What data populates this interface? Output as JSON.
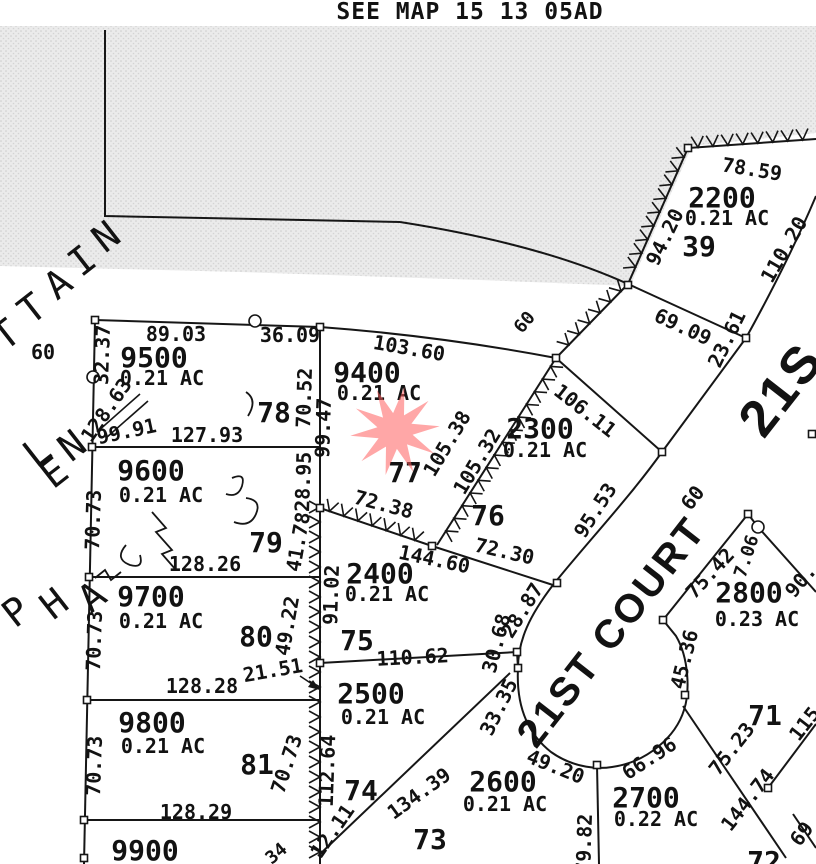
{
  "title": "SEE MAP 15 13 05AD",
  "star": {
    "color": "#ff5f5f",
    "meaning": "marker-on-lot-9400"
  },
  "streets": {
    "court_label": "21ST COURT",
    "main_street_partial": "21S",
    "right_of_way_widths": [
      "60",
      "60",
      "60"
    ],
    "diagonal_letters": [
      "T",
      "T",
      "A",
      "I",
      "N",
      "L",
      "E",
      "N",
      "P",
      "H",
      "A"
    ]
  },
  "lots": [
    {
      "parcel": "2200",
      "acreage": "0.21 AC",
      "lot": "39"
    },
    {
      "parcel": "9500",
      "acreage": "0.21 AC",
      "lot": "78"
    },
    {
      "parcel": "9400",
      "acreage": "0.21 AC",
      "lot": "77",
      "marked_with_star": true
    },
    {
      "parcel": "2300",
      "acreage": "0.21 AC",
      "lot": "76"
    },
    {
      "parcel": "2400",
      "acreage": "0.21 AC",
      "lot": "75"
    },
    {
      "parcel": "9600",
      "acreage": "0.21 AC",
      "lot": "79"
    },
    {
      "parcel": "9700",
      "acreage": "0.21 AC",
      "lot": "80"
    },
    {
      "parcel": "9800",
      "acreage": "0.21 AC",
      "lot": "81"
    },
    {
      "parcel": "2500",
      "acreage": "0.21 AC",
      "lot": "74"
    },
    {
      "parcel": "2600",
      "acreage": "0.21 AC",
      "lot": "73"
    },
    {
      "parcel": "2700",
      "acreage": "0.22 AC"
    },
    {
      "parcel": "2800",
      "acreage": "0.23 AC",
      "lot": "71"
    },
    {
      "parcel": "9900"
    },
    {
      "lot": "72",
      "partial": true
    }
  ],
  "labels": [
    {
      "t": "SEE MAP 15 13 05AD",
      "x": 470,
      "y": 19,
      "r": 0,
      "s": 23,
      "c": "title"
    },
    {
      "t": "2200",
      "x": 722,
      "y": 207,
      "r": 0,
      "s": 28,
      "c": "num"
    },
    {
      "t": "0.21 AC",
      "x": 727,
      "y": 225,
      "r": 0,
      "s": 20,
      "c": "ac"
    },
    {
      "t": "39",
      "x": 699,
      "y": 256,
      "r": 0,
      "s": 28,
      "c": "num"
    },
    {
      "t": "78.59",
      "x": 751,
      "y": 176,
      "r": 9,
      "s": 20,
      "c": "dim"
    },
    {
      "t": "94.20",
      "x": 671,
      "y": 240,
      "r": -64,
      "s": 20,
      "c": "dim"
    },
    {
      "t": "110.20",
      "x": 790,
      "y": 253,
      "r": -60,
      "s": 20,
      "c": "dim"
    },
    {
      "t": "69.09",
      "x": 680,
      "y": 333,
      "r": 25,
      "s": 20,
      "c": "dim"
    },
    {
      "t": "23.61",
      "x": 733,
      "y": 342,
      "r": -64,
      "s": 20,
      "c": "dim"
    },
    {
      "t": "9500",
      "x": 154,
      "y": 367,
      "r": 0,
      "s": 28,
      "c": "num"
    },
    {
      "t": "0.21 AC",
      "x": 162,
      "y": 385,
      "r": 0,
      "s": 20,
      "c": "ac"
    },
    {
      "t": "78",
      "x": 274,
      "y": 422,
      "r": 0,
      "s": 28,
      "c": "num"
    },
    {
      "t": "89.03",
      "x": 176,
      "y": 341,
      "r": 0,
      "s": 20,
      "c": "dim"
    },
    {
      "t": "36.09",
      "x": 290,
      "y": 342,
      "r": 0,
      "s": 20,
      "c": "dim"
    },
    {
      "t": "32.37",
      "x": 109,
      "y": 355,
      "r": -88,
      "s": 20,
      "c": "dim"
    },
    {
      "t": "70.52",
      "x": 311,
      "y": 398,
      "r": -88,
      "s": 20,
      "c": "dim"
    },
    {
      "t": "127.93",
      "x": 207,
      "y": 442,
      "r": 0,
      "s": 20,
      "c": "dim"
    },
    {
      "t": "128.63",
      "x": 112,
      "y": 414,
      "r": -55,
      "s": 20,
      "c": "dim"
    },
    {
      "t": "99.91",
      "x": 128,
      "y": 438,
      "r": -12,
      "s": 20,
      "c": "dim"
    },
    {
      "t": "60",
      "x": 43,
      "y": 359,
      "r": 0,
      "s": 20,
      "c": "dim"
    },
    {
      "t": "9400",
      "x": 367,
      "y": 382,
      "r": 0,
      "s": 28,
      "c": "num"
    },
    {
      "t": "0.21 AC",
      "x": 379,
      "y": 400,
      "r": 0,
      "s": 20,
      "c": "ac"
    },
    {
      "t": "77",
      "x": 405,
      "y": 482,
      "r": 0,
      "s": 28,
      "c": "num"
    },
    {
      "t": "103.60",
      "x": 408,
      "y": 355,
      "r": 10,
      "s": 20,
      "c": "dim"
    },
    {
      "t": "99.47",
      "x": 330,
      "y": 428,
      "r": -88,
      "s": 20,
      "c": "dim"
    },
    {
      "t": "105.38",
      "x": 453,
      "y": 447,
      "r": -59,
      "s": 20,
      "c": "dim"
    },
    {
      "t": "105.32",
      "x": 483,
      "y": 465,
      "r": -59,
      "s": 20,
      "c": "dim"
    },
    {
      "t": "72.38",
      "x": 382,
      "y": 511,
      "r": 15,
      "s": 20,
      "c": "dim"
    },
    {
      "t": "2300",
      "x": 540,
      "y": 438,
      "r": 0,
      "s": 28,
      "c": "num"
    },
    {
      "t": "0.21 AC",
      "x": 545,
      "y": 457,
      "r": 0,
      "s": 20,
      "c": "ac"
    },
    {
      "t": "76",
      "x": 488,
      "y": 525,
      "r": 0,
      "s": 28,
      "c": "num"
    },
    {
      "t": "106.11",
      "x": 581,
      "y": 416,
      "r": 38,
      "s": 20,
      "c": "dim"
    },
    {
      "t": "95.53",
      "x": 601,
      "y": 514,
      "r": -57,
      "s": 20,
      "c": "dim"
    },
    {
      "t": "72.30",
      "x": 503,
      "y": 558,
      "r": 13,
      "s": 20,
      "c": "dim"
    },
    {
      "t": "60",
      "x": 529,
      "y": 326,
      "r": -50,
      "s": 18,
      "c": "dim"
    },
    {
      "t": "2400",
      "x": 380,
      "y": 583,
      "r": 0,
      "s": 28,
      "c": "num"
    },
    {
      "t": "0.21 AC",
      "x": 387,
      "y": 601,
      "r": 0,
      "s": 20,
      "c": "ac"
    },
    {
      "t": "75",
      "x": 357,
      "y": 650,
      "r": 0,
      "s": 28,
      "c": "num"
    },
    {
      "t": "144.60",
      "x": 433,
      "y": 566,
      "r": 12,
      "s": 20,
      "c": "dim"
    },
    {
      "t": "91.02",
      "x": 338,
      "y": 595,
      "r": -88,
      "s": 20,
      "c": "dim"
    },
    {
      "t": "110.62",
      "x": 413,
      "y": 664,
      "r": -3,
      "s": 20,
      "c": "dim"
    },
    {
      "t": "30.68",
      "x": 503,
      "y": 645,
      "r": -75,
      "s": 20,
      "c": "dim"
    },
    {
      "t": "28.87",
      "x": 528,
      "y": 614,
      "r": -58,
      "s": 20,
      "c": "dim"
    },
    {
      "t": "28.95",
      "x": 310,
      "y": 482,
      "r": -88,
      "s": 20,
      "c": "dim"
    },
    {
      "t": "41.78",
      "x": 305,
      "y": 543,
      "r": -80,
      "s": 20,
      "c": "dim"
    },
    {
      "t": "49.22",
      "x": 294,
      "y": 627,
      "r": -80,
      "s": 20,
      "c": "dim"
    },
    {
      "t": "21.51",
      "x": 274,
      "y": 677,
      "r": -10,
      "s": 20,
      "c": "dim"
    },
    {
      "t": "9600",
      "x": 151,
      "y": 480,
      "r": 0,
      "s": 28,
      "c": "num"
    },
    {
      "t": "0.21 AC",
      "x": 161,
      "y": 502,
      "r": 0,
      "s": 20,
      "c": "ac"
    },
    {
      "t": "79",
      "x": 266,
      "y": 552,
      "r": 0,
      "s": 28,
      "c": "num"
    },
    {
      "t": "70.73",
      "x": 100,
      "y": 520,
      "r": -88,
      "s": 20,
      "c": "dim"
    },
    {
      "t": "128.26",
      "x": 205,
      "y": 571,
      "r": 0,
      "s": 20,
      "c": "dim"
    },
    {
      "t": "9700",
      "x": 151,
      "y": 606,
      "r": 0,
      "s": 28,
      "c": "num"
    },
    {
      "t": "0.21 AC",
      "x": 161,
      "y": 628,
      "r": 0,
      "s": 20,
      "c": "ac"
    },
    {
      "t": "80",
      "x": 256,
      "y": 646,
      "r": 0,
      "s": 28,
      "c": "num"
    },
    {
      "t": "70.73",
      "x": 101,
      "y": 641,
      "r": -88,
      "s": 20,
      "c": "dim"
    },
    {
      "t": "128.28",
      "x": 202,
      "y": 693,
      "r": 0,
      "s": 20,
      "c": "dim"
    },
    {
      "t": "9800",
      "x": 152,
      "y": 732,
      "r": 0,
      "s": 28,
      "c": "num"
    },
    {
      "t": "0.21 AC",
      "x": 163,
      "y": 753,
      "r": 0,
      "s": 20,
      "c": "ac"
    },
    {
      "t": "81",
      "x": 257,
      "y": 774,
      "r": 0,
      "s": 28,
      "c": "num"
    },
    {
      "t": "70.73",
      "x": 101,
      "y": 766,
      "r": -88,
      "s": 20,
      "c": "dim"
    },
    {
      "t": "70.73",
      "x": 293,
      "y": 766,
      "r": -72,
      "s": 20,
      "c": "dim"
    },
    {
      "t": "112.64",
      "x": 334,
      "y": 771,
      "r": -88,
      "s": 20,
      "c": "dim"
    },
    {
      "t": "128.29",
      "x": 196,
      "y": 819,
      "r": 0,
      "s": 20,
      "c": "dim"
    },
    {
      "t": "9900",
      "x": 145,
      "y": 860,
      "r": 0,
      "s": 28,
      "c": "num"
    },
    {
      "t": "34",
      "x": 280,
      "y": 858,
      "r": -40,
      "s": 18,
      "c": "dim"
    },
    {
      "t": "12.11",
      "x": 338,
      "y": 835,
      "r": -55,
      "s": 20,
      "c": "dim"
    },
    {
      "t": "2500",
      "x": 371,
      "y": 703,
      "r": 0,
      "s": 28,
      "c": "num"
    },
    {
      "t": "0.21 AC",
      "x": 383,
      "y": 724,
      "r": 0,
      "s": 20,
      "c": "ac"
    },
    {
      "t": "74",
      "x": 361,
      "y": 800,
      "r": 0,
      "s": 28,
      "c": "num"
    },
    {
      "t": "134.39",
      "x": 423,
      "y": 799,
      "r": -36,
      "s": 20,
      "c": "dim"
    },
    {
      "t": "33.35",
      "x": 505,
      "y": 710,
      "r": -64,
      "s": 20,
      "c": "dim"
    },
    {
      "t": "2600",
      "x": 503,
      "y": 791,
      "r": 0,
      "s": 28,
      "c": "num"
    },
    {
      "t": "0.21 AC",
      "x": 505,
      "y": 811,
      "r": 0,
      "s": 20,
      "c": "ac"
    },
    {
      "t": "73",
      "x": 430,
      "y": 849,
      "r": 0,
      "s": 28,
      "c": "num"
    },
    {
      "t": "49.20",
      "x": 553,
      "y": 773,
      "r": 22,
      "s": 20,
      "c": "dim"
    },
    {
      "t": "79.82",
      "x": 591,
      "y": 844,
      "r": -88,
      "s": 20,
      "c": "dim"
    },
    {
      "t": "2700",
      "x": 646,
      "y": 807,
      "r": 0,
      "s": 28,
      "c": "num"
    },
    {
      "t": "0.22 AC",
      "x": 656,
      "y": 826,
      "r": 0,
      "s": 20,
      "c": "ac"
    },
    {
      "t": "66.96",
      "x": 653,
      "y": 764,
      "r": -33,
      "s": 20,
      "c": "dim"
    },
    {
      "t": "2800",
      "x": 749,
      "y": 602,
      "r": 0,
      "s": 28,
      "c": "num"
    },
    {
      "t": "0.23 AC",
      "x": 757,
      "y": 626,
      "r": 0,
      "s": 20,
      "c": "ac"
    },
    {
      "t": "71",
      "x": 765,
      "y": 725,
      "r": 0,
      "s": 28,
      "c": "num"
    },
    {
      "t": "75.42",
      "x": 715,
      "y": 578,
      "r": -47,
      "s": 20,
      "c": "dim"
    },
    {
      "t": "7.06",
      "x": 752,
      "y": 558,
      "r": -72,
      "s": 18,
      "c": "dim"
    },
    {
      "t": "90.",
      "x": 806,
      "y": 585,
      "r": -50,
      "s": 20,
      "c": "dim"
    },
    {
      "t": "45.36",
      "x": 691,
      "y": 661,
      "r": -76,
      "s": 20,
      "c": "dim"
    },
    {
      "t": "75.23",
      "x": 737,
      "y": 753,
      "r": -52,
      "s": 20,
      "c": "dim"
    },
    {
      "t": "144.74",
      "x": 753,
      "y": 804,
      "r": -52,
      "s": 20,
      "c": "dim"
    },
    {
      "t": "115",
      "x": 810,
      "y": 728,
      "r": -52,
      "s": 20,
      "c": "dim"
    },
    {
      "t": "69",
      "x": 807,
      "y": 838,
      "r": -52,
      "s": 20,
      "c": "dim"
    },
    {
      "t": "72",
      "x": 764,
      "y": 871,
      "r": 0,
      "s": 28,
      "c": "num"
    },
    {
      "t": "21ST COURT",
      "x": 622,
      "y": 640,
      "r": -52,
      "s": 40,
      "c": "street"
    },
    {
      "t": "21S",
      "x": 795,
      "y": 400,
      "r": -52,
      "s": 52,
      "c": "street"
    },
    {
      "t": "60",
      "x": 698,
      "y": 502,
      "r": -52,
      "s": 20,
      "c": "dim"
    },
    {
      "t": "T",
      "x": 14,
      "y": 345,
      "r": -38,
      "s": 38,
      "c": "letter"
    },
    {
      "t": "T",
      "x": 40,
      "y": 319,
      "r": -38,
      "s": 38,
      "c": "letter"
    },
    {
      "t": "A",
      "x": 66,
      "y": 294,
      "r": -38,
      "s": 38,
      "c": "letter"
    },
    {
      "t": "I",
      "x": 90,
      "y": 271,
      "r": -38,
      "s": 38,
      "c": "letter"
    },
    {
      "t": "N",
      "x": 114,
      "y": 247,
      "r": -38,
      "s": 38,
      "c": "letter"
    },
    {
      "t": "L",
      "x": 45,
      "y": 462,
      "r": -38,
      "s": 38,
      "c": "letter"
    },
    {
      "t": "E",
      "x": 62,
      "y": 483,
      "r": -38,
      "s": 38,
      "c": "letter"
    },
    {
      "t": "N",
      "x": 80,
      "y": 456,
      "r": -38,
      "s": 38,
      "c": "letter"
    },
    {
      "t": "P",
      "x": 24,
      "y": 622,
      "r": -38,
      "s": 38,
      "c": "letter"
    },
    {
      "t": "H",
      "x": 62,
      "y": 614,
      "r": -38,
      "s": 38,
      "c": "letter"
    },
    {
      "t": "A",
      "x": 100,
      "y": 607,
      "r": -38,
      "s": 38,
      "c": "letter"
    }
  ]
}
